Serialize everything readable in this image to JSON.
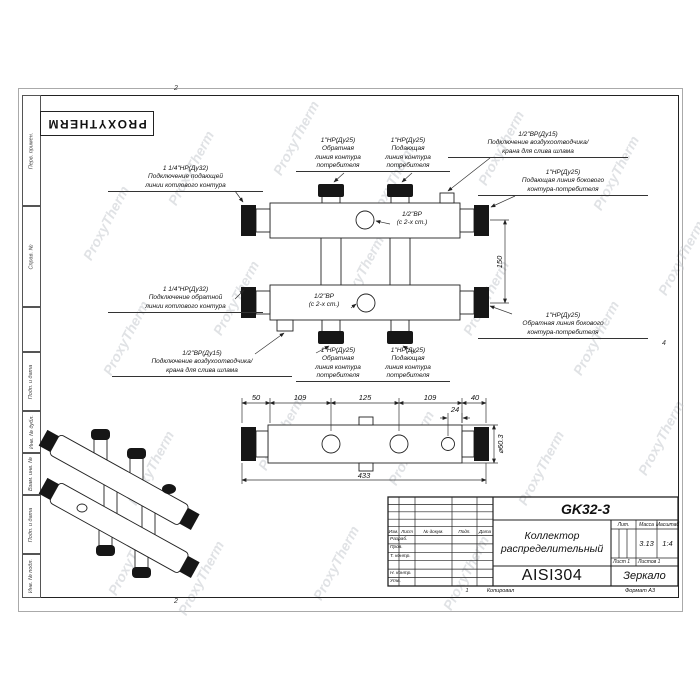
{
  "brand": {
    "stamp": "PROXYTHERM",
    "watermark": "ProxyTherm"
  },
  "frame": {
    "zone_top": "2",
    "zone_bottom": "2",
    "zone_right": "4",
    "margin_labels": [
      "Перв. примен.",
      "Справ. №",
      "Подп. и дата",
      "Инв. № дубл.",
      "Взам. инв. №",
      "Подп. и дата",
      "Инв. № подл."
    ]
  },
  "annotations": {
    "boiler_supply": "1 1/4\"НР(Ду32)\nПодключение подающей\nлинии котлового контура",
    "consumer_return_top": "1\"НР(Ду25)\nОбратная\nлиния контура\nпотребителя",
    "consumer_supply_top": "1\"НР(Ду25)\nПодающая\nлиния контура\nпотребителя",
    "air_vent_top": "1/2\"ВР(Ду15)\nПодключение воздухоотводчика/\nкрана для слива шлама",
    "side_supply": "1\"НР(Ду25)\nПодающая линия бокового\nконтура-потребителя",
    "plug_top": "1/2\"ВР\n(с 2-х ст.)",
    "boiler_return": "1 1/4\"НР(Ду32)\nПодключение обратной\nлинии котлового контура",
    "air_vent_bottom": "1/2\"ВР(Ду15)\nПодключение воздухоотводчика/\nкрана для слива шлама",
    "consumer_return_bottom": "1\"НР(Ду25)\nОбратная\nлиния контура\nпотребителя",
    "consumer_supply_bottom": "1\"НР(Ду25)\nПодающая\nлиния контура\nпотребителя",
    "side_return": "1\"НР(Ду25)\nОбратная линия бокового\nконтура-потребителя",
    "plug_bottom": "1/2\"ВР\n(с 2-х ст.)"
  },
  "dimensions": {
    "v150": "150",
    "top_row": [
      "50",
      "109",
      "125",
      "109",
      "40"
    ],
    "d24": "24",
    "total": "433",
    "diameter": "⌀60.3"
  },
  "title_block": {
    "doc_number": "GK32-3",
    "part_name": "Коллектор\nраспределительный",
    "material": "AISI304",
    "note": "Зеркало",
    "lit_label": "Лит.",
    "mass_label": "Масса",
    "scale_label": "Масштаб",
    "mass_value": "3.13",
    "scale_value": "1:4",
    "sheet_label": "Лист 1",
    "sheets_label": "Листов 1",
    "header_cols": [
      "Изм.",
      "Лист",
      "№ докум.",
      "Подп.",
      "Дата"
    ],
    "rows": [
      "Разраб.",
      "Пров.",
      "Т. контр.",
      "",
      "Н. контр.",
      "Утв."
    ],
    "footer_copy_num": "1",
    "footer_copy": "Копировал",
    "footer_format": "Формат А3"
  }
}
